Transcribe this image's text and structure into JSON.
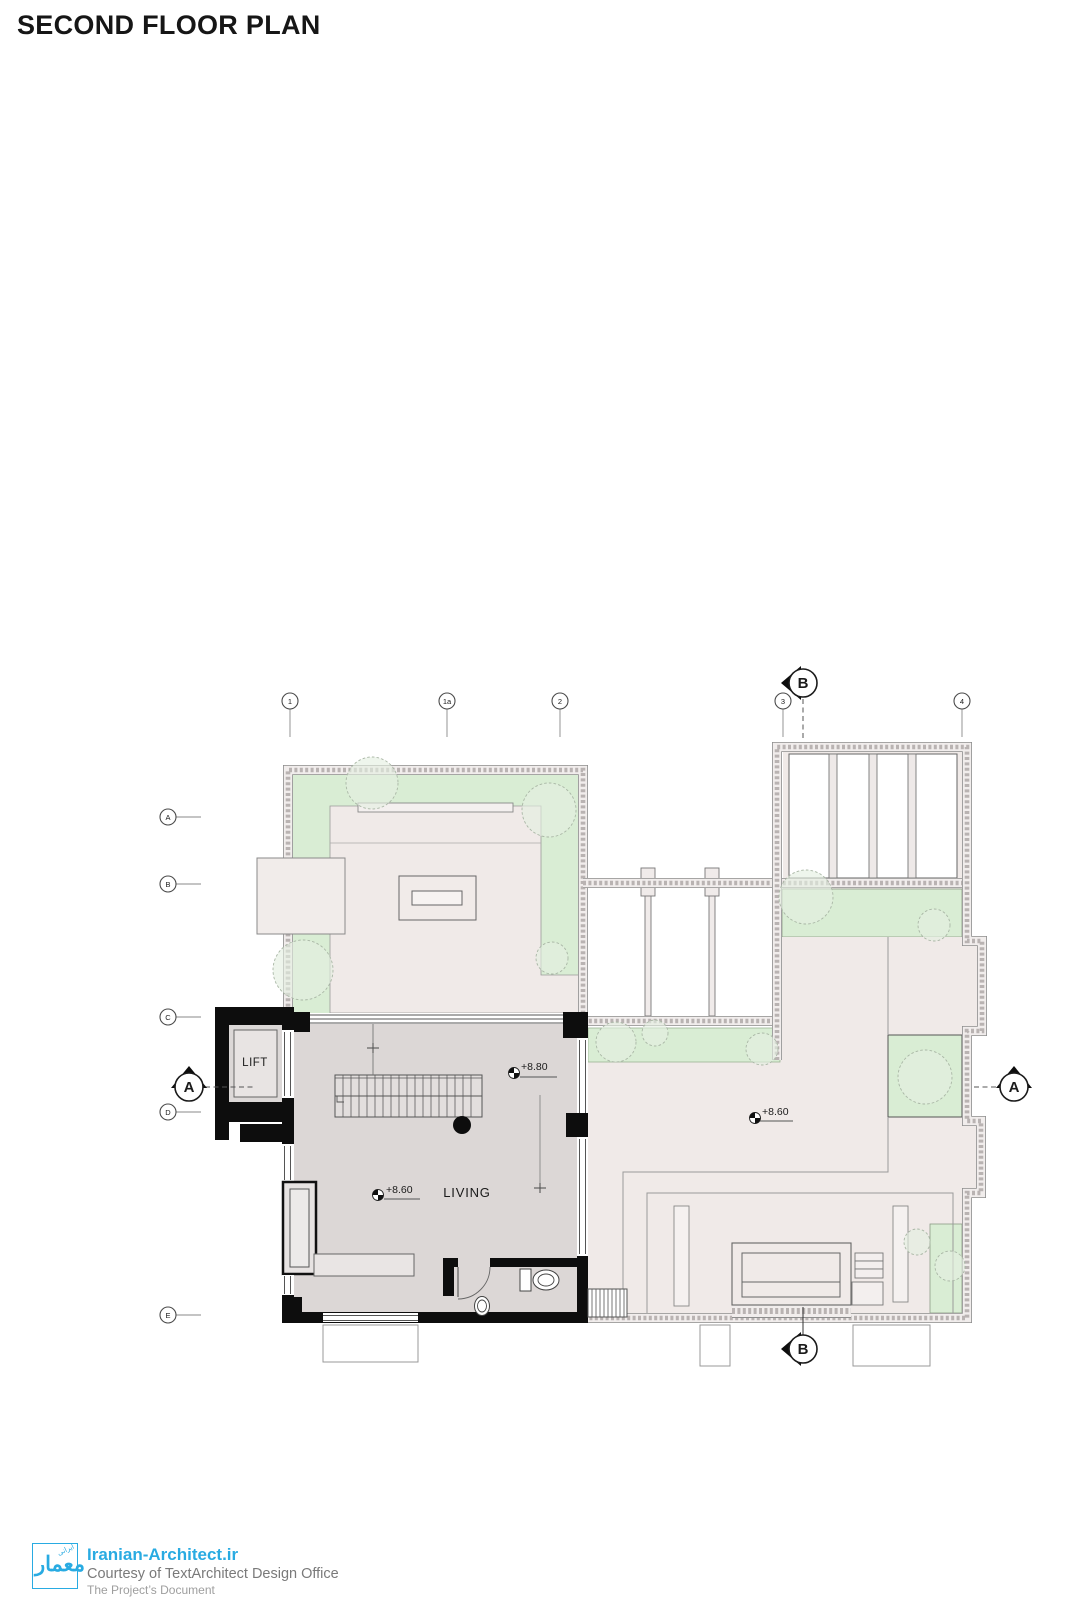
{
  "title": "SECOND FLOOR PLAN",
  "grid": {
    "columns": [
      "1",
      "1a",
      "2",
      "3",
      "4"
    ],
    "rows": [
      "A",
      "B",
      "C",
      "D",
      "E"
    ]
  },
  "sections": {
    "a": "A",
    "b": "B"
  },
  "rooms": {
    "lift": "LIFT",
    "living": "LIVING"
  },
  "levels": {
    "stair": "+8.80",
    "living": "+8.60",
    "terrace": "+8.60"
  },
  "footer": {
    "logo_main": "معمار",
    "logo_small": "ایرانی",
    "site": "Iranian-Architect.ir",
    "courtesy": "Courtesy of TextArchitect Design Office",
    "doc": "The Project’s Document"
  },
  "colors": {
    "accent": "#29ABE2",
    "green": "#D9EDD4",
    "terrace_floor": "#F0EAE8",
    "living_floor": "#DCD7D6",
    "wall": "#0D0D0D"
  }
}
